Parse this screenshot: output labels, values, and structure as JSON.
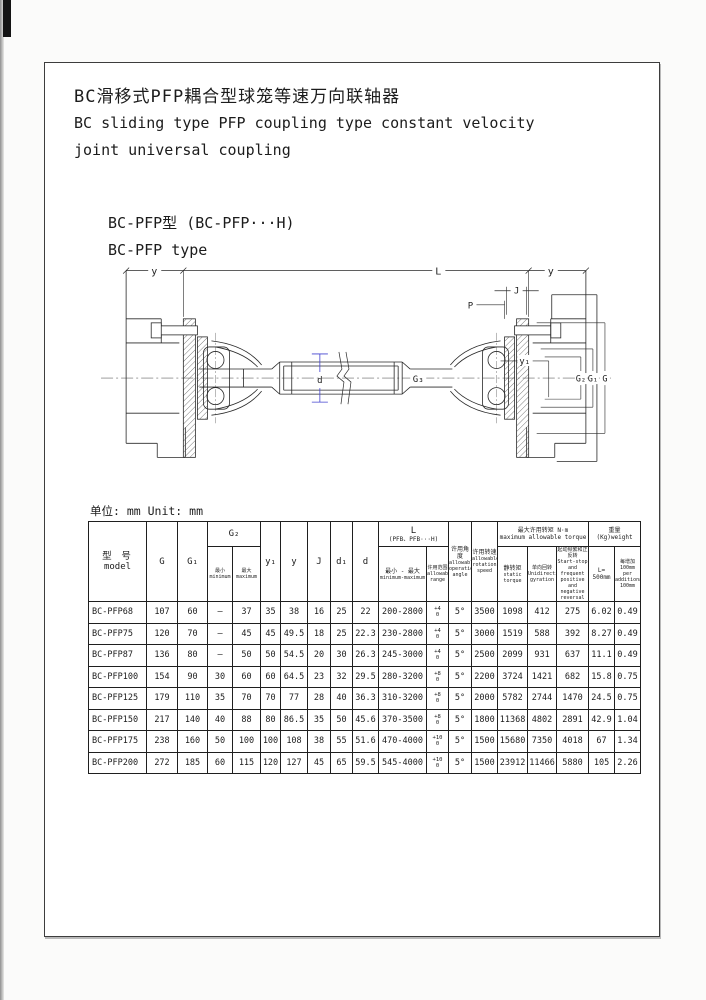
{
  "page": {
    "title_zh": "BC滑移式PFP耦合型球笼等速万向联轴器",
    "title_en1": "BC sliding type PFP coupling type constant velocity",
    "title_en2": "joint universal coupling",
    "model_line1": "BC-PFP型  (BC-PFP···H)",
    "model_line2": "BC-PFP type"
  },
  "drawing": {
    "dim_y_left": "y",
    "dim_l": "L",
    "dim_y_right": "y",
    "dim_j": "J",
    "dim_p": "P",
    "dim_d": "d",
    "dim_g3": "G₃",
    "dim_y1": "y₁",
    "dim_g2": "G₂",
    "dim_g1": "G₁",
    "dim_g": "G"
  },
  "table": {
    "unit": "单位: mm Unit: mm",
    "h": {
      "model_zh": "型 号",
      "model_en": "model",
      "g": "G",
      "g1": "G₁",
      "g2": "G₂",
      "min_zh": "最小",
      "min_en": "minimum",
      "max_zh": "最大",
      "max_en": "maximum",
      "y1": "y₁",
      "y": "y",
      "j": "J",
      "d1": "d₁",
      "d": "d",
      "l_zh": "L",
      "l_sub": "(PFB、PFB···H)",
      "lrange_zh": "最小 - 最大",
      "lrange_en": "minimum-maximum",
      "allow_zh": "许用范围",
      "allow_en": "allowable range",
      "angle_zh": "许用角度",
      "angle_en": "allowable operation angle",
      "speed_zh": "许用转速",
      "speed_en": "allowable rotation speed",
      "torque_zh": "最大许用转矩  N·m",
      "torque_en": "maximum allowable torque",
      "static_zh": "静转矩",
      "static_en": "static torque",
      "uni_zh": "单向回转",
      "uni_en": "Unidirectional gyration",
      "ss_zh": "起动频繁和正反转",
      "ss_en": "Start-stop and frequent positive and negative reversal",
      "weight_zh": "重量 (Kg)weight",
      "w500_line1": "L=",
      "w500_line2": "500mm",
      "w100_zh": "每增加 100mm",
      "w100_en": "per additional 100mm"
    },
    "rows": [
      {
        "model": "BC-PFP68",
        "g": "107",
        "g1": "60",
        "g2min": "—",
        "g2max": "37",
        "y1": "35",
        "y": "38",
        "j": "16",
        "d1": "25",
        "d": "22",
        "l_range": "200-2800",
        "tol": [
          "+4",
          "0"
        ],
        "angle": "5°",
        "speed": "3500",
        "static_torque": "1098",
        "unidirectional": "412",
        "start_stop": "275",
        "w500": "6.02",
        "w100": "0.49"
      },
      {
        "model": "BC-PFP75",
        "g": "120",
        "g1": "70",
        "g2min": "—",
        "g2max": "45",
        "y1": "45",
        "y": "49.5",
        "j": "18",
        "d1": "25",
        "d": "22.3",
        "l_range": "230-2800",
        "tol": [
          "+4",
          "0"
        ],
        "angle": "5°",
        "speed": "3000",
        "static_torque": "1519",
        "unidirectional": "588",
        "start_stop": "392",
        "w500": "8.27",
        "w100": "0.49"
      },
      {
        "model": "BC-PFP87",
        "g": "136",
        "g1": "80",
        "g2min": "—",
        "g2max": "50",
        "y1": "50",
        "y": "54.5",
        "j": "20",
        "d1": "30",
        "d": "26.3",
        "l_range": "245-3000",
        "tol": [
          "+4",
          "0"
        ],
        "angle": "5°",
        "speed": "2500",
        "static_torque": "2099",
        "unidirectional": "931",
        "start_stop": "637",
        "w500": "11.1",
        "w100": "0.49"
      },
      {
        "model": "BC-PFP100",
        "g": "154",
        "g1": "90",
        "g2min": "30",
        "g2max": "60",
        "y1": "60",
        "y": "64.5",
        "j": "23",
        "d1": "32",
        "d": "29.5",
        "l_range": "280-3200",
        "tol": [
          "+8",
          "0"
        ],
        "angle": "5°",
        "speed": "2200",
        "static_torque": "3724",
        "unidirectional": "1421",
        "start_stop": "682",
        "w500": "15.8",
        "w100": "0.75"
      },
      {
        "model": "BC-PFP125",
        "g": "179",
        "g1": "110",
        "g2min": "35",
        "g2max": "70",
        "y1": "70",
        "y": "77",
        "j": "28",
        "d1": "40",
        "d": "36.3",
        "l_range": "310-3200",
        "tol": [
          "+8",
          "0"
        ],
        "angle": "5°",
        "speed": "2000",
        "static_torque": "5782",
        "unidirectional": "2744",
        "start_stop": "1470",
        "w500": "24.5",
        "w100": "0.75"
      },
      {
        "model": "BC-PFP150",
        "g": "217",
        "g1": "140",
        "g2min": "40",
        "g2max": "88",
        "y1": "80",
        "y": "86.5",
        "j": "35",
        "d1": "50",
        "d": "45.6",
        "l_range": "370-3500",
        "tol": [
          "+8",
          "0"
        ],
        "angle": "5°",
        "speed": "1800",
        "static_torque": "11368",
        "unidirectional": "4802",
        "start_stop": "2891",
        "w500": "42.9",
        "w100": "1.04"
      },
      {
        "model": "BC-PFP175",
        "g": "238",
        "g1": "160",
        "g2min": "50",
        "g2max": "100",
        "y1": "100",
        "y": "108",
        "j": "38",
        "d1": "55",
        "d": "51.6",
        "l_range": "470-4000",
        "tol": [
          "+10",
          "0"
        ],
        "angle": "5°",
        "speed": "1500",
        "static_torque": "15680",
        "unidirectional": "7350",
        "start_stop": "4018",
        "w500": "67",
        "w100": "1.34"
      },
      {
        "model": "BC-PFP200",
        "g": "272",
        "g1": "185",
        "g2min": "60",
        "g2max": "115",
        "y1": "120",
        "y": "127",
        "j": "45",
        "d1": "65",
        "d": "59.5",
        "l_range": "545-4000",
        "tol": [
          "+10",
          "0"
        ],
        "angle": "5°",
        "speed": "1500",
        "static_torque": "23912",
        "unidirectional": "11466",
        "start_stop": "5880",
        "w500": "105",
        "w100": "2.26"
      }
    ]
  }
}
